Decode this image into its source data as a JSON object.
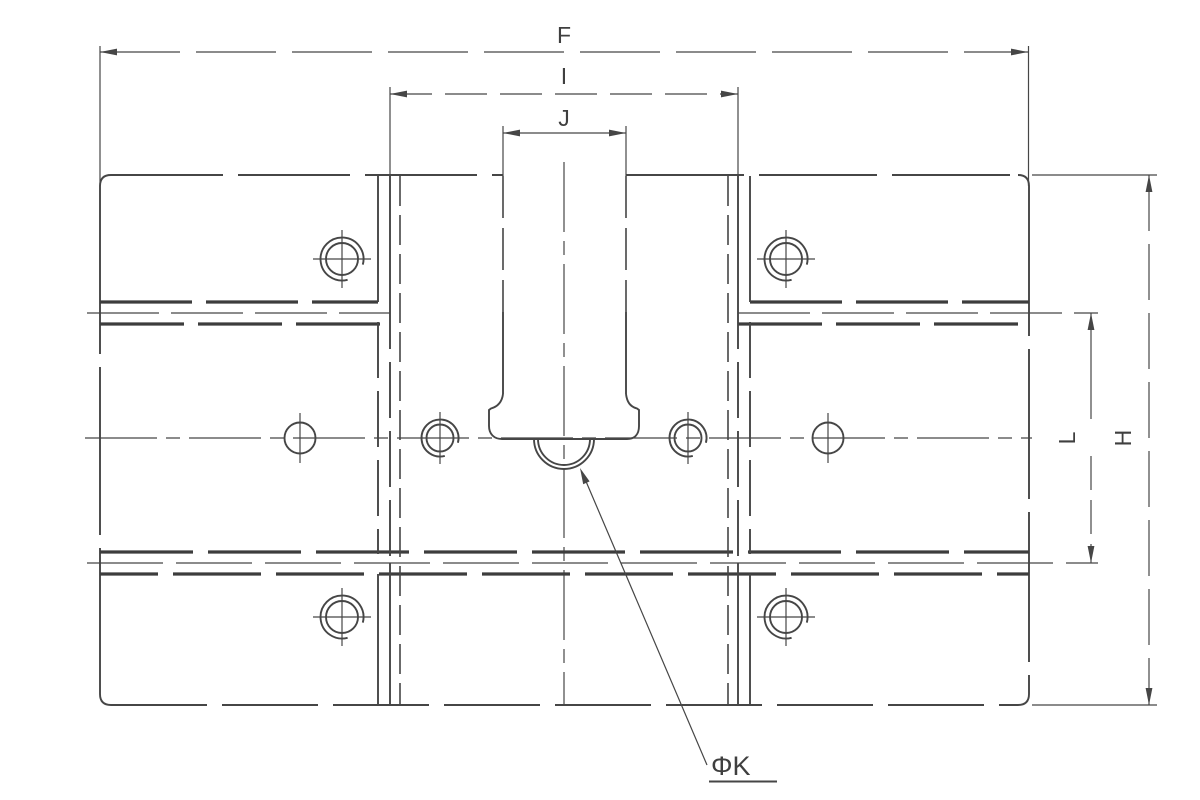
{
  "drawing": {
    "type": "engineering-dimension-drawing",
    "labels": {
      "overall_width": "F",
      "inner_width": "I",
      "slot_width": "J",
      "overall_height": "H",
      "rail_spacing": "L",
      "hole_diameter": "ΦK"
    },
    "colors": {
      "background": "#ffffff",
      "line": "#464646",
      "thick_line": "#3d3d3d",
      "text": "#3f3f3f"
    }
  }
}
